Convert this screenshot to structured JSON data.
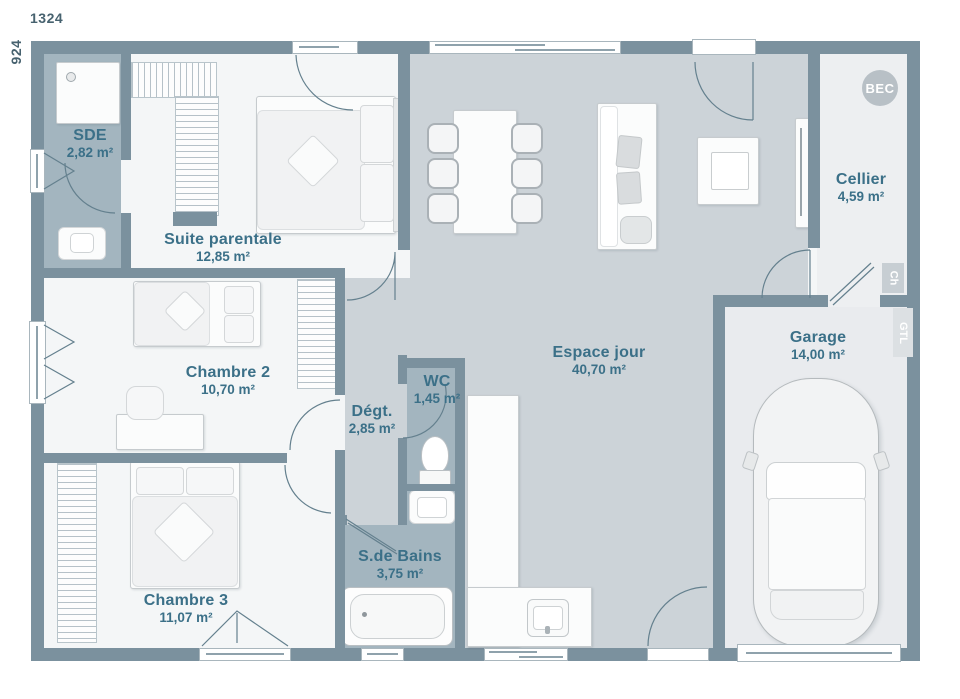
{
  "plan": {
    "dimension_width_cm": "1324",
    "dimension_height_cm": "924",
    "rooms": [
      {
        "name": "SDE",
        "area": "2,82 m²"
      },
      {
        "name": "Suite parentale",
        "area": "12,85 m²"
      },
      {
        "name": "Chambre 2",
        "area": "10,70 m²"
      },
      {
        "name": "Chambre 3",
        "area": "11,07 m²"
      },
      {
        "name": "Dégt.",
        "area": "2,85 m²"
      },
      {
        "name": "WC",
        "area": "1,45 m²"
      },
      {
        "name": "S.de Bains",
        "area": "3,75 m²"
      },
      {
        "name": "Espace jour",
        "area": "40,70 m²"
      },
      {
        "name": "Cellier",
        "area": "4,59 m²"
      },
      {
        "name": "Garage",
        "area": "14,00 m²"
      }
    ],
    "annotations": {
      "bec": "BEC",
      "ch": "Ch",
      "gtl": "GTL"
    },
    "colors": {
      "wall": "#7b919e",
      "floor_bedrooms": "#f4f6f7",
      "floor_living": "#ccd3d8",
      "floor_wet": "#a3b5bf",
      "floor_cellier": "#edeff1",
      "floor_garage": "#e9ebee",
      "label_text": "#3b7088"
    }
  }
}
